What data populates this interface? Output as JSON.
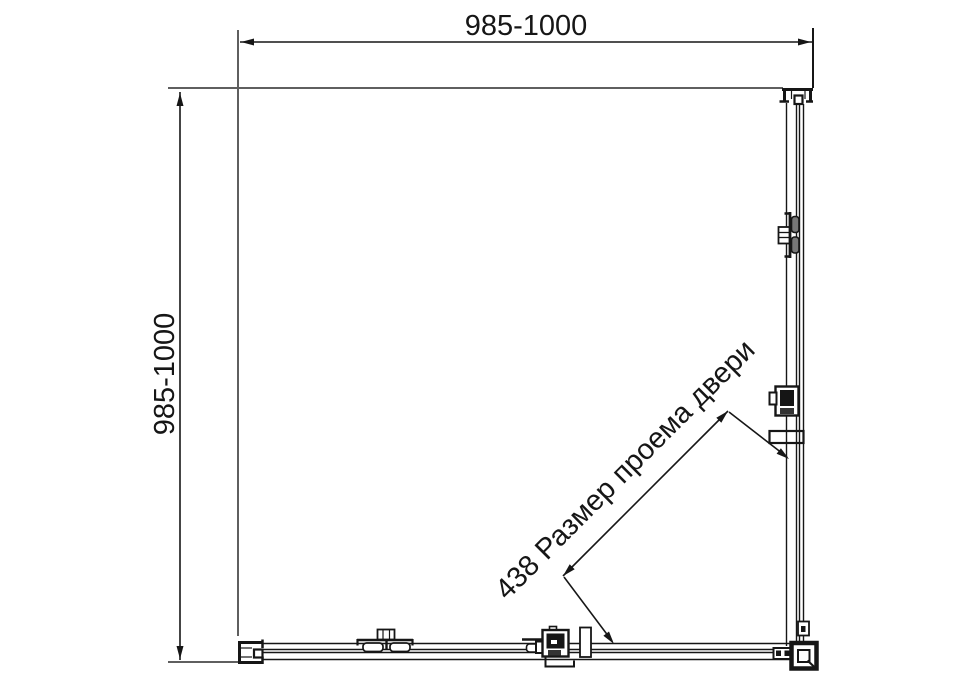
{
  "drawing": {
    "title": "shower-enclosure-square-top-view",
    "dim_top": "985-1000",
    "dim_left": "985-1000",
    "dim_diagonal": "438 Размер проема двери"
  },
  "colors": {
    "line": "#161616",
    "wall_line": "#5f5f5f",
    "roller_fill": "#777777",
    "background": "#ffffff"
  }
}
